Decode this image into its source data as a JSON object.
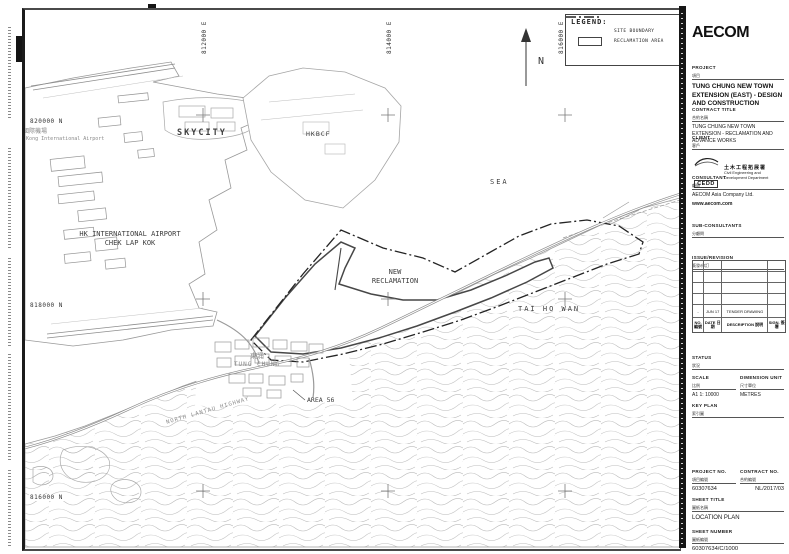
{
  "legend": {
    "title": "LEGEND:",
    "site_boundary": "SITE BOUNDARY",
    "reclamation_area": "RECLAMATION AREA"
  },
  "north_label": "N",
  "grid": {
    "eastings": [
      "812000 E",
      "814000 E",
      "816000 E"
    ],
    "northings": [
      "820000 N",
      "818000 N",
      "816000 N"
    ]
  },
  "map": {
    "airport_cn": "香港國際機場",
    "airport_en_small": "Hong Kong International Airport",
    "airport_l1": "HK INTERNATIONAL AIRPORT",
    "airport_l2": "CHEK LAP KOK",
    "skycity": "SKYCITY",
    "hkbcf": "HKBCF",
    "sea": "SEA",
    "new_reclamation_l1": "NEW",
    "new_reclamation_l2": "RECLAMATION",
    "tai_ho_wan": "TAI HO WAN",
    "tung_chung_cn": "東涌",
    "tung_chung_en": "TUNG CHUNG",
    "area_56": "AREA 56",
    "north_lantau_highway": "NORTH LANTAU HIGHWAY"
  },
  "titleblock": {
    "brand": "AECOM",
    "project_label": "PROJECT",
    "project_label_cn": "項目",
    "project": "TUNG CHUNG NEW TOWN EXTENSION (EAST) - DESIGN AND CONSTRUCTION",
    "contract_title_label": "CONTRACT TITLE",
    "contract_title_label_cn": "合約名稱",
    "contract_title": "TUNG CHUNG NEW TOWN EXTENSION - RECLAMATION AND ADVANCE WORKS",
    "client_label": "CLIENT",
    "client_label_cn": "客戶",
    "client_logo": "CEDD",
    "client_cn": "土木工程拓展署",
    "client_en": "Civil Engineering and Development Department",
    "consultant_label": "CONSULTANT",
    "consultant_label_cn": "顧問",
    "consultant": "AECOM Asia Company Ltd.",
    "consultant_url": "www.aecom.com",
    "subconsultants_label": "SUB-CONSULTANTS",
    "subconsultants_label_cn": "分顧問",
    "issue_label": "ISSUE/REVISION",
    "issue_label_cn": "簽發/修訂",
    "rev_headers": {
      "no": "NO. 編號",
      "date": "DATE 日期",
      "description": "DESCRIPTION 說明",
      "sign": "SIGN. 簽署"
    },
    "revision": {
      "no": "-",
      "date": "JUN 17",
      "description": "TENDER DRAWING",
      "sign": ""
    },
    "status_label": "STATUS",
    "status_label_cn": "狀況",
    "scale_label": "SCALE",
    "scale_label_cn": "比例",
    "scale": "A1 1: 10000",
    "dimension_unit_label": "DIMENSION UNIT",
    "dimension_unit_label_cn": "尺寸單位",
    "dimension_unit": "METRES",
    "key_plan_label": "KEY PLAN",
    "key_plan_label_cn": "索引圖",
    "project_no_label": "PROJECT NO.",
    "project_no_label_cn": "項目編號",
    "project_no": "60307634",
    "contract_no_label": "CONTRACT NO.",
    "contract_no_label_cn": "合約編號",
    "contract_no": "NL/2017/03",
    "sheet_title_label": "SHEET TITLE",
    "sheet_title_label_cn": "圖紙名稱",
    "sheet_title": "LOCATION PLAN",
    "sheet_number_label": "SHEET NUMBER",
    "sheet_number_label_cn": "圖紙編號",
    "sheet_number": "60307634/C/1000"
  }
}
